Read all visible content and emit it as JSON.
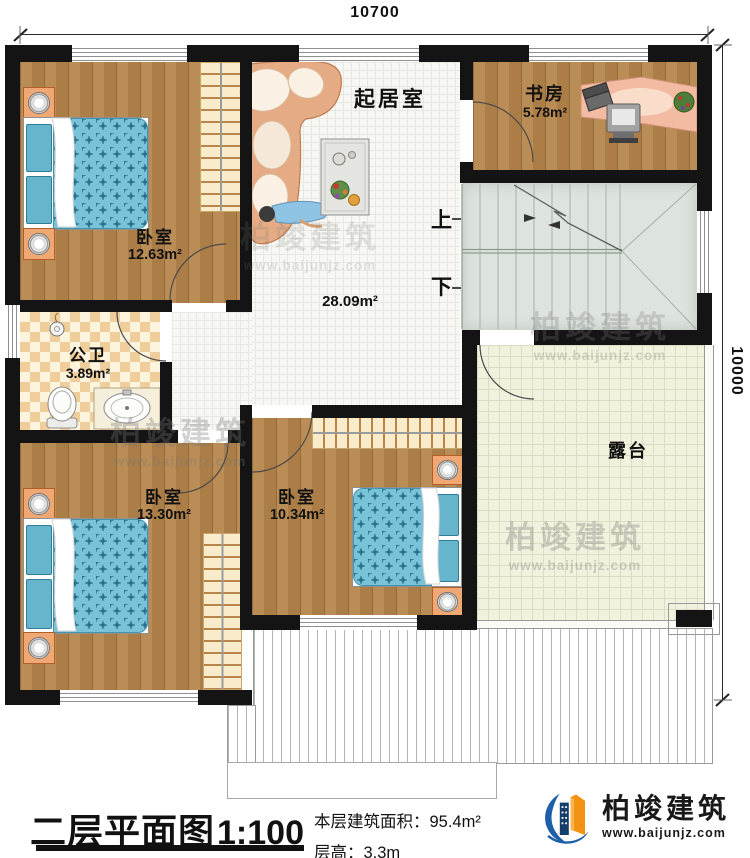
{
  "dimensions": {
    "top": "10700",
    "right": "10000"
  },
  "rooms": {
    "living": {
      "name": "起居室",
      "area": "28.09m²"
    },
    "study": {
      "name": "书房",
      "area": "5.78m²"
    },
    "bedroom_tl": {
      "name": "卧室",
      "area": "12.63m²"
    },
    "bedroom_bl": {
      "name": "卧室",
      "area": "13.30m²"
    },
    "bedroom_bm": {
      "name": "卧室",
      "area": "10.34m²"
    },
    "bathroom": {
      "name": "公卫",
      "area": "3.89m²"
    },
    "terrace": {
      "name": "露台"
    }
  },
  "stairs": {
    "up_label": "上",
    "down_label": "下"
  },
  "title_block": {
    "title": "二层平面图",
    "scale": "1:100",
    "area_label": "本层建筑面积：",
    "area_value": "95.4m²",
    "floor_height_label": "层高：",
    "floor_height_value": "3.3m"
  },
  "branding": {
    "logo_text": "柏竣建筑",
    "logo_site": "www.baijunjz.com"
  },
  "watermark": {
    "text": "柏竣建筑",
    "site": "www.baijunjz.com"
  },
  "colors": {
    "wall": "#141414",
    "wood_floor": "#b6854b",
    "bed_blue": "#79c3d9",
    "terrace_floor": "#f1f1dd",
    "stair_floor": "#dde3dd",
    "bathroom_tile": "#efce9c",
    "sofa_peach": "#e5ab84",
    "logo_blue": "#1d5fa8",
    "logo_orange": "#f39110"
  }
}
